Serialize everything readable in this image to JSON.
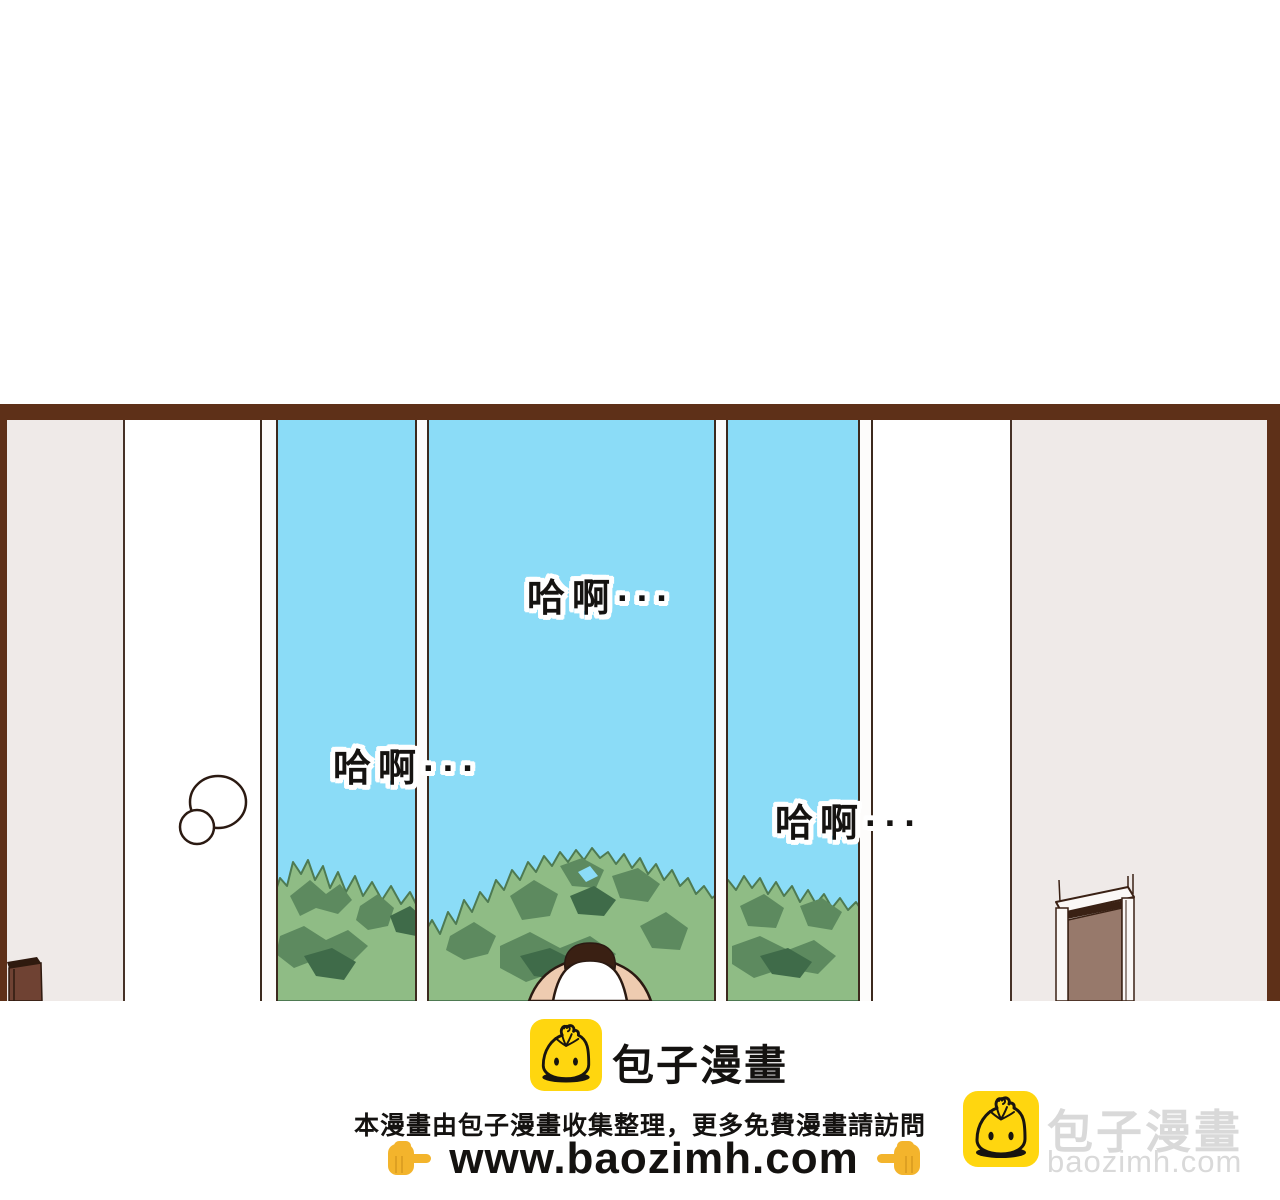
{
  "panel": {
    "sfx": [
      "哈啊···",
      "哈啊···",
      "哈啊···"
    ]
  },
  "footer": {
    "brand": {
      "icon": "baozi-bun-icon",
      "name": "包子漫畫"
    },
    "notice": "本漫畫由包子漫畫收集整理，更多免費漫畫請訪問",
    "url": "www.baozimh.com",
    "hand_left_glyph": "👉",
    "hand_right_glyph": "👈"
  },
  "watermark": {
    "icon": "baozi-bun-icon",
    "name": "包子漫畫",
    "domain": "baozimh.com"
  },
  "colors": {
    "sky": "#8bdcf7",
    "panel_border": "#5e3018",
    "wall_gray": "#efeae8",
    "tree_light": "#8fbc85",
    "tree_mid": "#5d8a5f",
    "tree_deep": "#3f6b49",
    "outline": "#2b1a12",
    "skin": "#eecbb0",
    "hair": "#3a2013",
    "shirt": "#ffffff",
    "door_slab": "#97796b",
    "cabinet_brown": "#6f4233",
    "brand_yellow": "#ffd60f",
    "hand_yellow": "#f3b42c",
    "text_black": "#141210",
    "watermark_gray": "#d9d9d9"
  }
}
